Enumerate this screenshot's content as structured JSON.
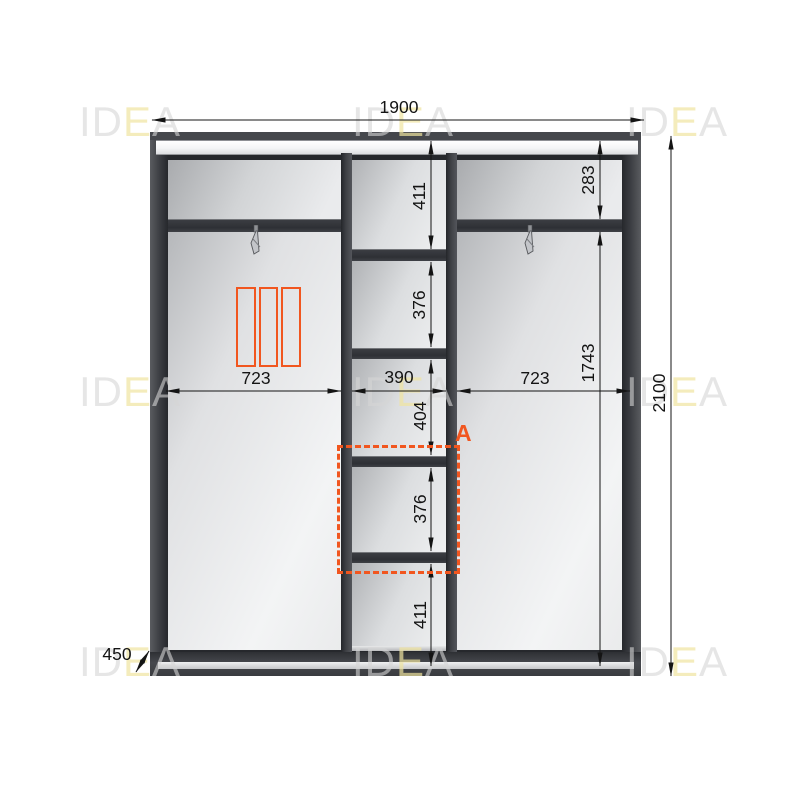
{
  "brand": {
    "watermark_gray_1": "ID",
    "watermark_yellow": "E",
    "watermark_gray_2": "A"
  },
  "dimensions": {
    "overall_width": "1900",
    "overall_height": "2100",
    "depth": "450",
    "left_section_width": "723",
    "middle_section_width": "390",
    "right_section_width": "723",
    "middle_column_heights": [
      "411",
      "376",
      "404",
      "376",
      "411"
    ],
    "right_top_shelf_height": "283",
    "right_hanging_height": "1743"
  },
  "annotations": {
    "section_label": "A"
  },
  "colors": {
    "accent_orange": "#F1561F",
    "frame_dark": "#3C3E43",
    "dimension_ink": "#141414",
    "watermark_gray": "#D6D6D6",
    "watermark_yellow": "#F0E4A0"
  }
}
